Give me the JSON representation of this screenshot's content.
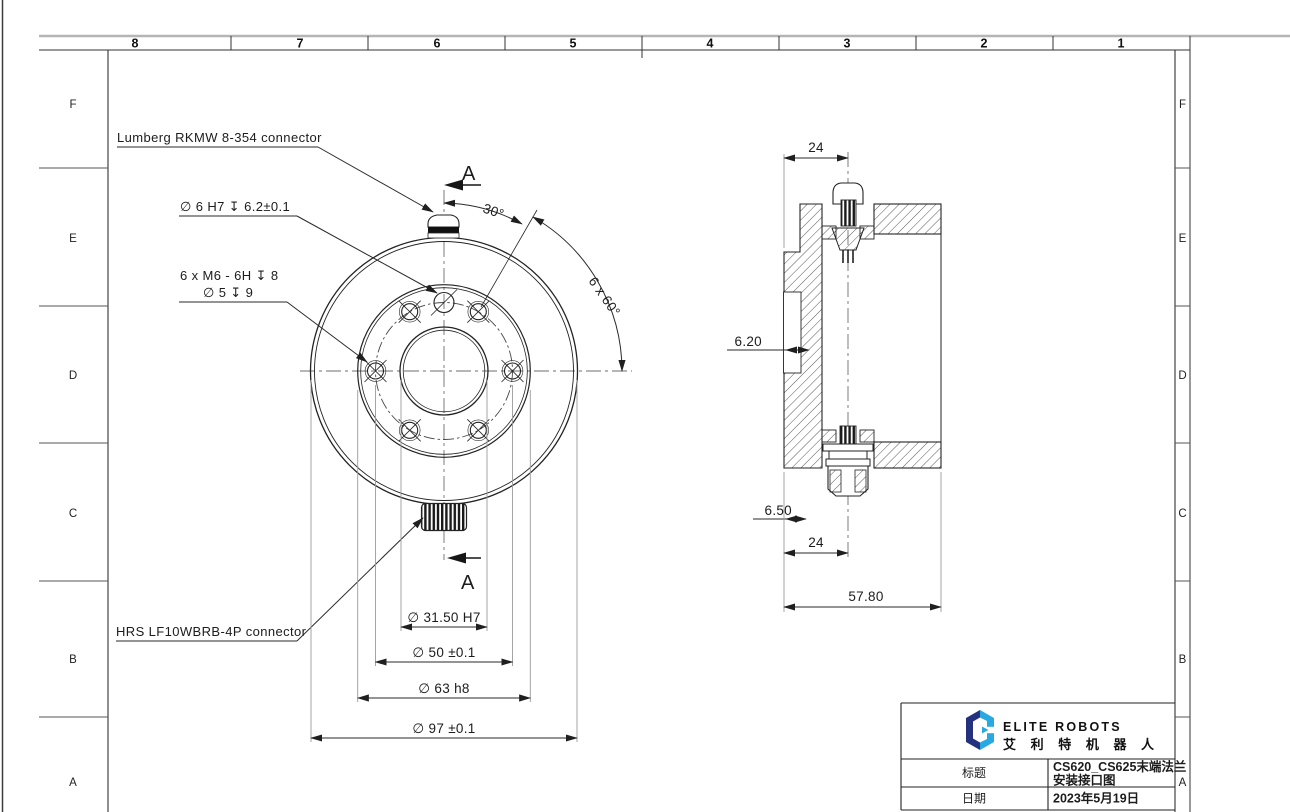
{
  "sheet": {
    "zone_columns": [
      "8",
      "7",
      "6",
      "5",
      "4",
      "3",
      "2",
      "1"
    ],
    "zone_rows": [
      "F",
      "E",
      "D",
      "C",
      "B",
      "A"
    ]
  },
  "front_view": {
    "section_label": "A",
    "callouts": {
      "top_connector": "Lumberg RKMW 8-354 connector",
      "bottom_connector": "HRS LF10WBRB-4P  connector",
      "dowel_hole": "∅ 6 H7 ↧ 6.2±0.1",
      "thread_spec": "6 x  M6 - 6H ↧ 8",
      "thread_pilot": "∅ 5 ↧ 9"
    },
    "dimensions": {
      "angle_offset": "30°",
      "angle_pattern": "6 x 60°",
      "bore": "∅ 31.50 H7",
      "bolt_circle": "∅ 50 ±0.1",
      "pilot": "∅ 63 h8",
      "outer": "∅ 97 ±0.1"
    }
  },
  "side_view": {
    "dimensions": {
      "top_offset": "24",
      "recess_depth": "6.20",
      "step_depth": "6.50",
      "bottom_offset": "24",
      "overall_width": "57.80"
    }
  },
  "title_block": {
    "brand_name": "ELITE ROBOTS",
    "brand_name_cn": "艾 利 特 机 器 人",
    "brand_navy": "#24317e",
    "brand_cyan": "#29a9e1",
    "title_label": "标题",
    "title_value_line1": "CS620_CS625末端法兰",
    "title_value_line2": "安装接口图",
    "date_label": "日期",
    "date_value": "2023年5月19日"
  }
}
